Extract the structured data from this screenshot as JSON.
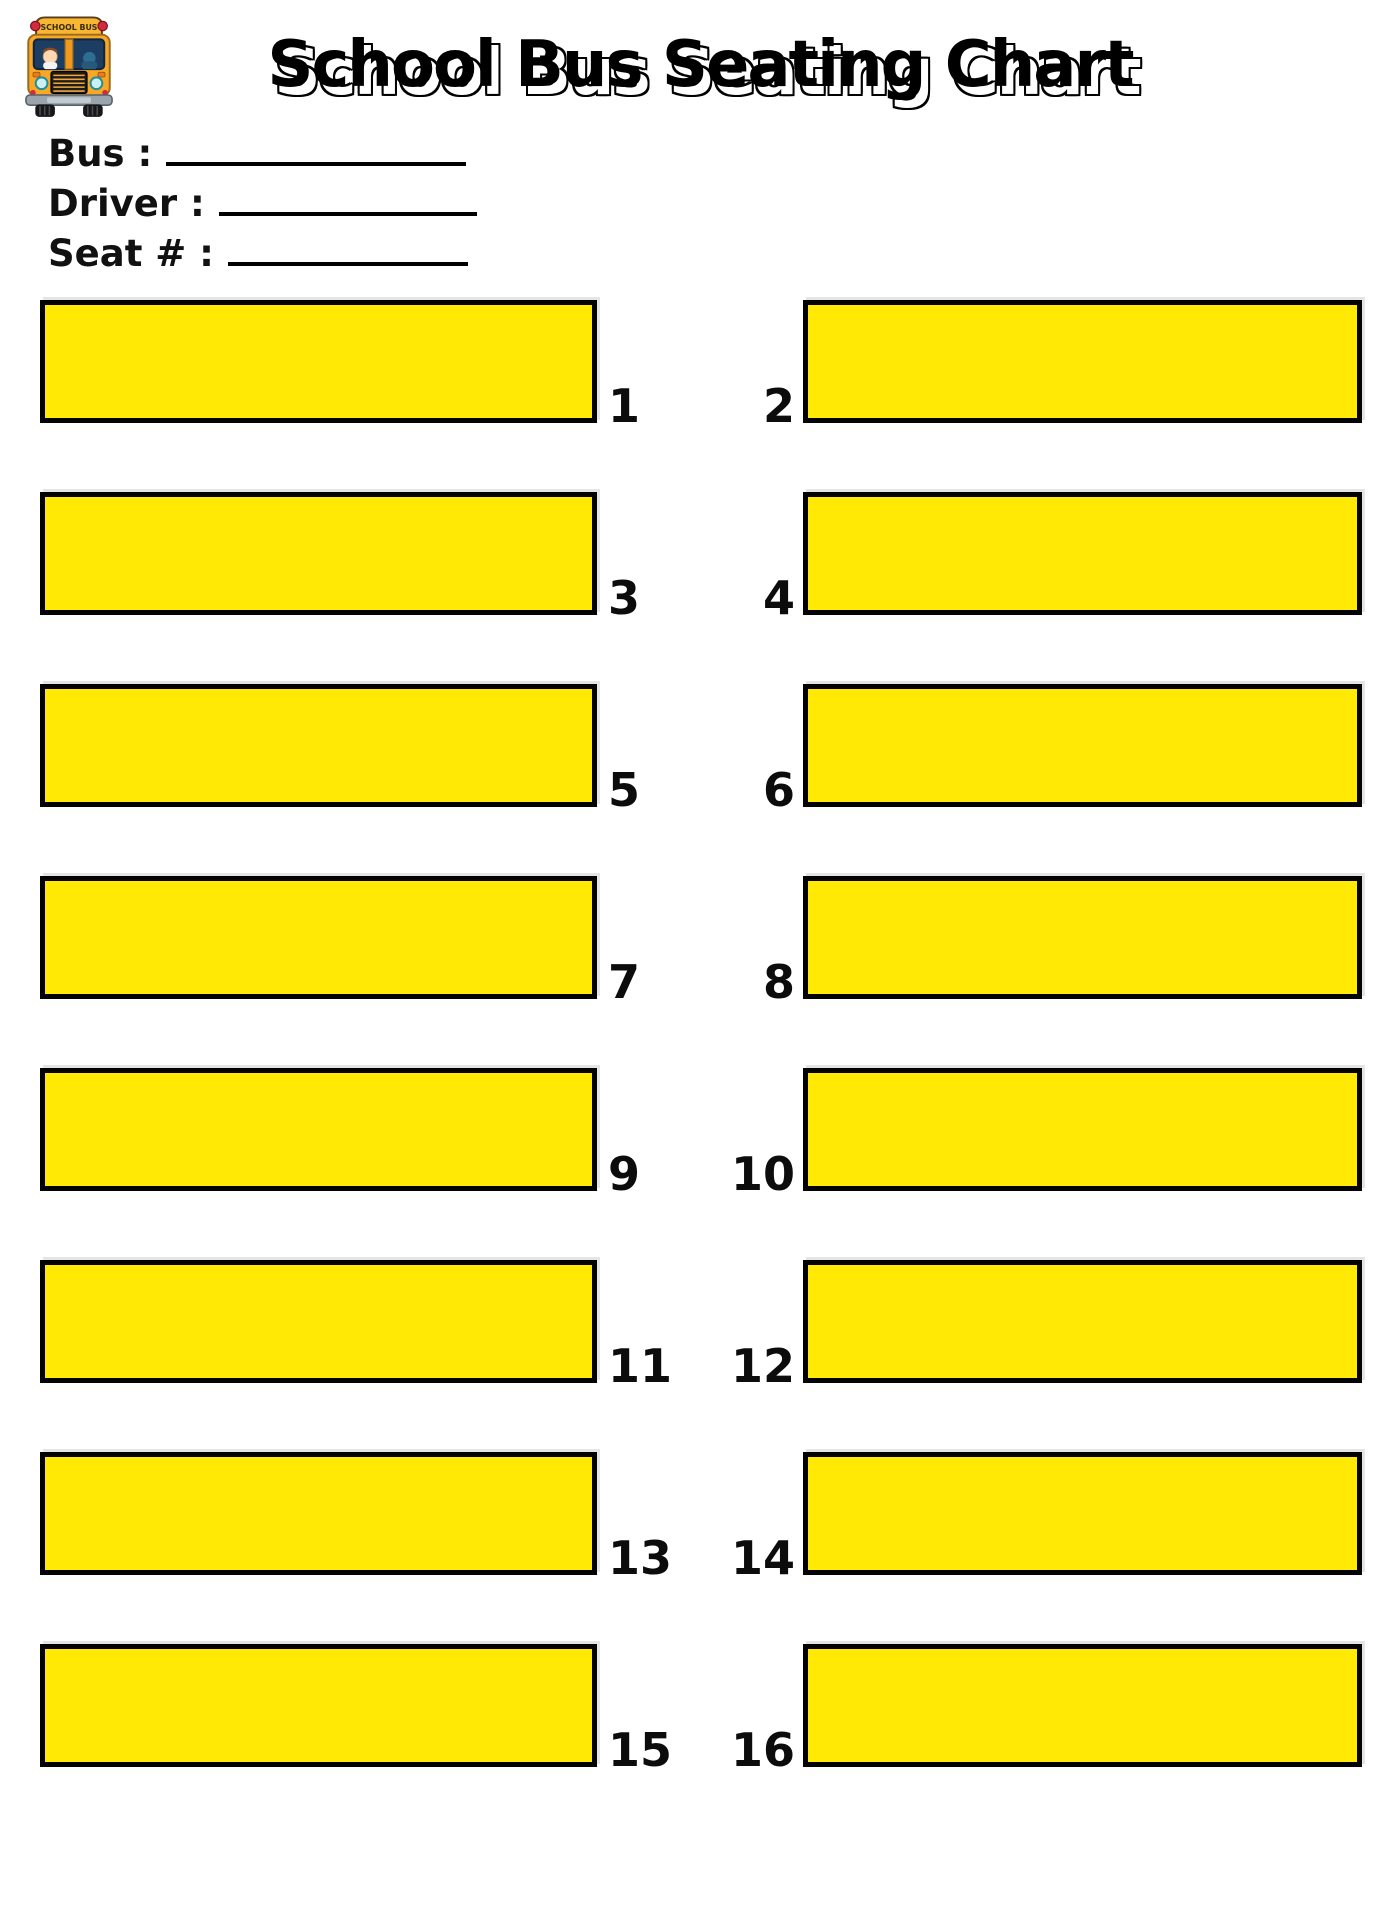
{
  "header": {
    "title": "School Bus Seating Chart",
    "logo_sign_text": "SCHOOL BUS"
  },
  "form": {
    "fields": [
      {
        "label": "Bus :"
      },
      {
        "label": "Driver :"
      },
      {
        "label": "Seat #  :"
      }
    ]
  },
  "seating": {
    "seat_fill_color": "#FFE905",
    "seat_border_color": "#000000",
    "rows": [
      {
        "left": "1",
        "right": "2"
      },
      {
        "left": "3",
        "right": "4"
      },
      {
        "left": "5",
        "right": "6"
      },
      {
        "left": "7",
        "right": "8"
      },
      {
        "left": "9",
        "right": "10"
      },
      {
        "left": "11",
        "right": "12"
      },
      {
        "left": "13",
        "right": "14"
      },
      {
        "left": "15",
        "right": "16"
      }
    ]
  }
}
